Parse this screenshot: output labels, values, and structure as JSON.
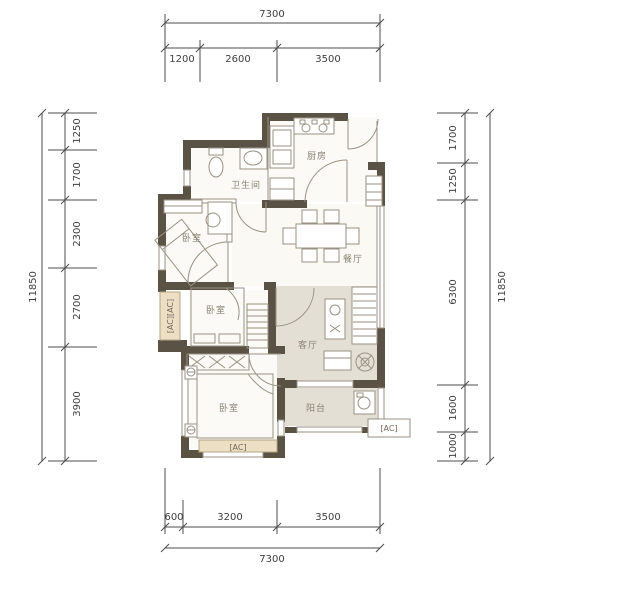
{
  "dimensions": {
    "top": {
      "overall": "7300",
      "segments": [
        "1200",
        "2600",
        "3500"
      ]
    },
    "bottom": {
      "overall": "7300",
      "segments": [
        "600",
        "3200",
        "3500"
      ]
    },
    "left": {
      "overall": "11850",
      "segments": [
        "1250",
        "1700",
        "2300",
        "2700",
        "3900"
      ]
    },
    "right": {
      "overall": "11850",
      "segments": [
        "1700",
        "1250",
        "6300",
        "1600",
        "1000"
      ]
    }
  },
  "rooms": {
    "kitchen": "厨房",
    "bathroom": "卫生间",
    "bedroom_top": "卧室",
    "bedroom_middle": "卧室",
    "bedroom_bottom": "卧室",
    "dining": "餐厅",
    "living": "客厅",
    "balcony": "阳台"
  },
  "ac_units": {
    "left_wall": "[AC][AC]",
    "bottom_wall": "[AC]",
    "right_wall": "[AC]"
  },
  "colors": {
    "wall": "#5a5244",
    "floor_shade": "#e4dfd5",
    "ac_fill": "#ecdfc4",
    "sketch_line": "#9a9183",
    "dimension_text": "#3f3f3f"
  }
}
